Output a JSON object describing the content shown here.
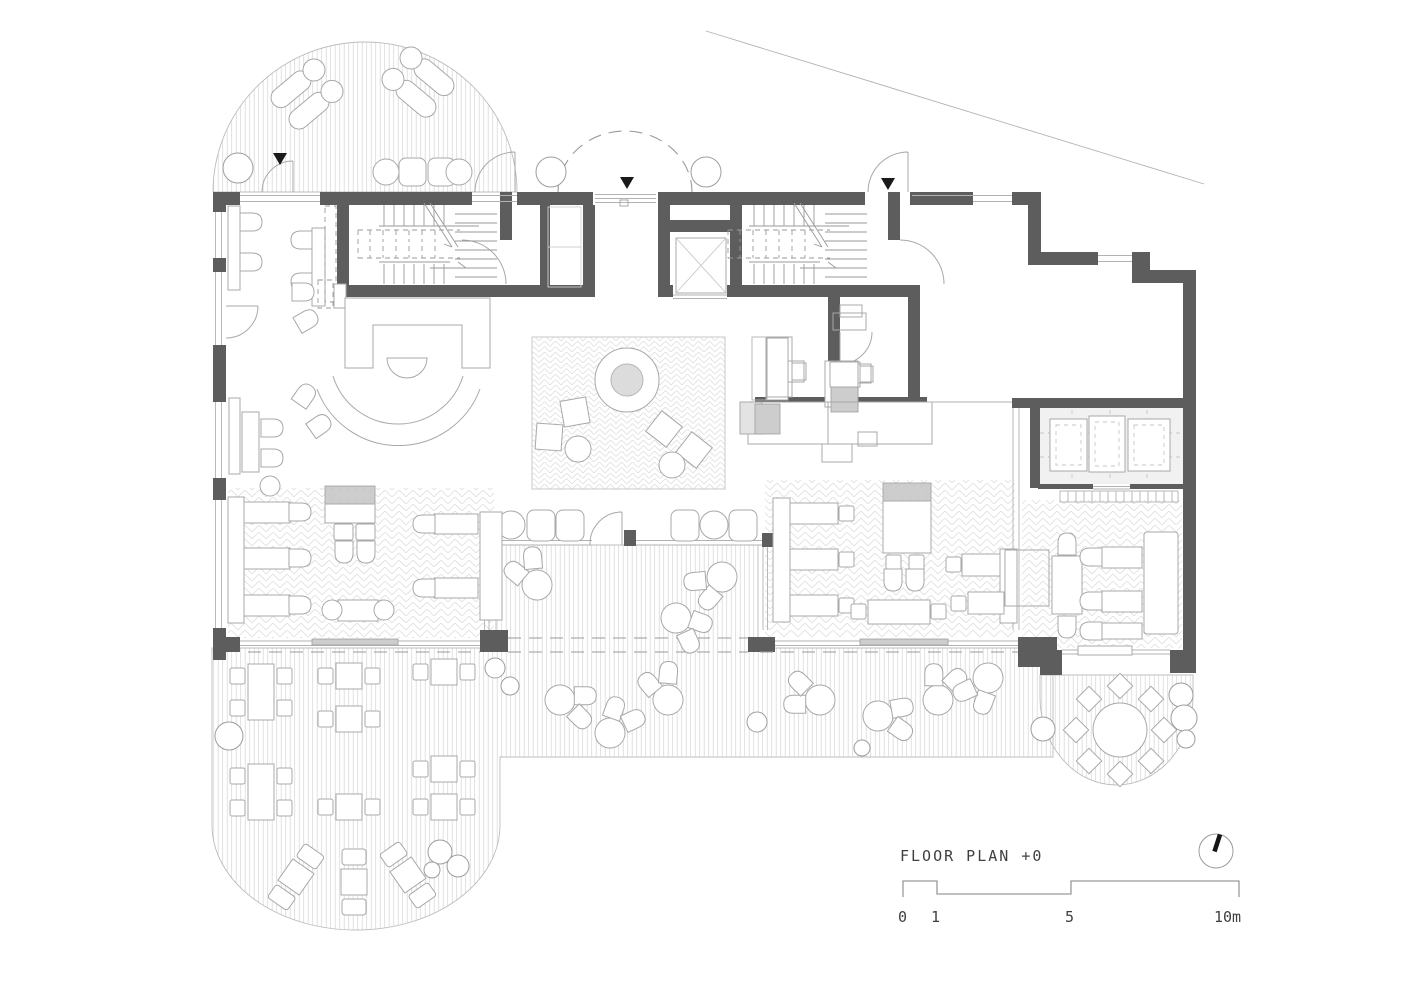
{
  "plan": {
    "title": "FLOOR PLAN +0",
    "scale": {
      "t0": "0",
      "t1": "1",
      "t5": "5",
      "t10": "10m"
    },
    "colors": {
      "wall": "#5d5d5d",
      "furniture_line": "#a8a8a8",
      "hatch_line": "#d8d8d8",
      "gray_fill": "#cdcdcd",
      "entrance_marker": "#1a1a1a",
      "text": "#3f3f3f",
      "background": "#ffffff"
    },
    "icons": {
      "north_indicator": "north-dial-icon",
      "entrance_marker": "entrance-triangle-icon"
    }
  }
}
